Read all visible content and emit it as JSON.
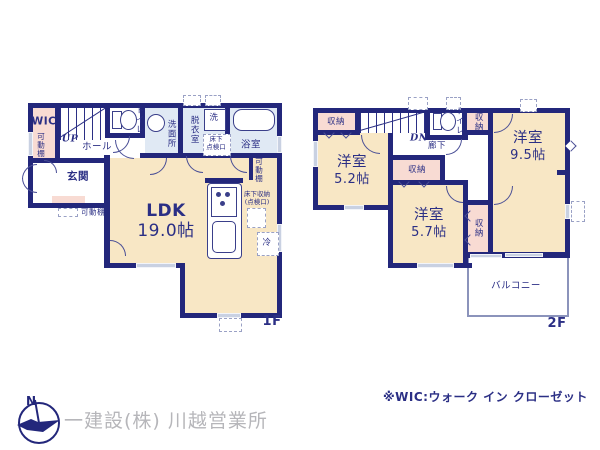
{
  "colors": {
    "wall": "#23277b",
    "text": "#2b2f85",
    "room_cream": "#f8e7c5",
    "closet_pink": "#f8dbd3",
    "wet_blue": "#e0e9f4",
    "window_gray": "#c9d1e2",
    "company_gray": "#b6b6ba"
  },
  "f1": {
    "tag": "1F",
    "wic": "WIC",
    "kadodana_wic": "可動棚",
    "up": "UP",
    "hall": "ホール",
    "toilet": "トイレ",
    "senmen": "洗面所",
    "datsui": "脱衣室",
    "sen": "洗",
    "yukashita_tenken": "床下\n点検口",
    "bath": "浴室",
    "kadodana_r": "可動棚",
    "genkan": "玄関",
    "kadodana_b": "可動棚",
    "ldk": "LDK",
    "ldk_size": "19.0帖",
    "yukashita_shuno": "床下収納\n(点検口)",
    "rei": "冷"
  },
  "f2": {
    "tag": "2F",
    "shuno_tl": "収納",
    "dn": "DN",
    "rouka": "廊下",
    "toilet": "トイレ",
    "shuno_tm": "収納",
    "r95": "洋室",
    "r95_size": "9.5帖",
    "r52": "洋室",
    "r52_size": "5.2帖",
    "shuno_mid": "収納",
    "r57": "洋室",
    "r57_size": "5.7帖",
    "shuno_r": "収納",
    "balcony": "バルコニー"
  },
  "footer": {
    "compass_n": "N",
    "company": "一建設(株) 川越営業所",
    "wic_note": "※WIC:ウォーク イン クローゼット"
  }
}
